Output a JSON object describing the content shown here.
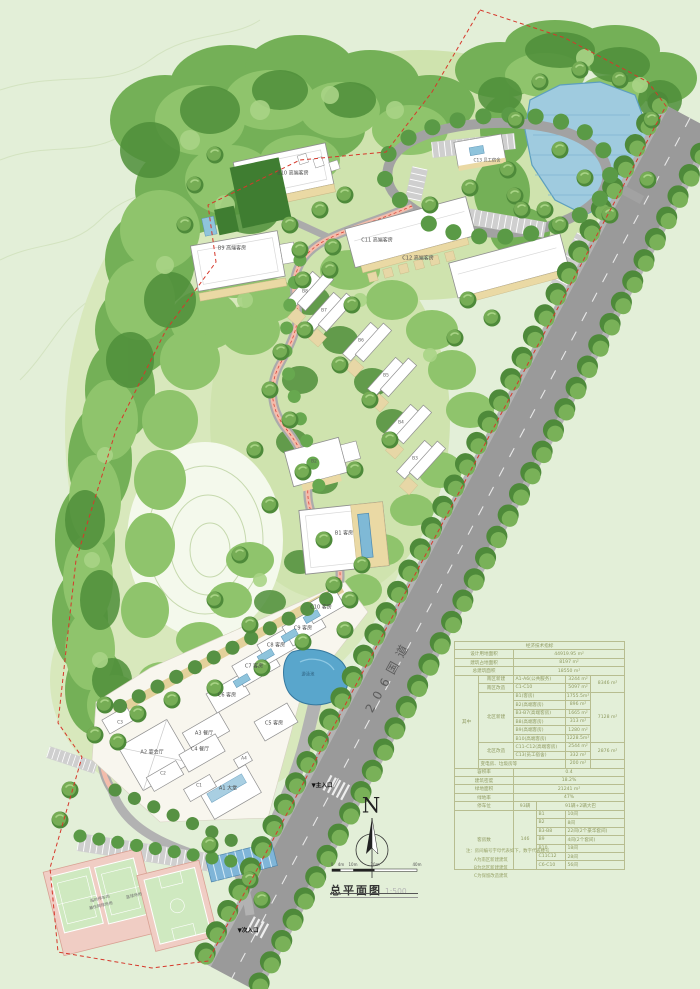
{
  "title_block": {
    "title": "总平面图",
    "scale": "1:500",
    "north_label": "N",
    "scale_bar_ticks": [
      "0",
      "4m",
      "10m",
      "20m",
      "40m"
    ]
  },
  "labels": {
    "road": "206国道",
    "main_entrance": "▼主入口",
    "side_entrance": "▼次入口",
    "pool": "游泳池",
    "tennis1": "临时停车场",
    "tennis2": "兼作网球场地",
    "basketball": "篮球场地",
    "a1": "A1 大堂",
    "a2": "A2 宴会厅",
    "a3": "A3 餐厅",
    "a4": "A4",
    "b1": "B1 客房",
    "b2": "B2",
    "b3": "B3",
    "b4": "B4",
    "b5": "B5",
    "b6": "B6",
    "b7": "B7",
    "b8": "B8",
    "b9": "B9 高端客房",
    "b10": "B10 高端客房",
    "c1": "C1",
    "c2": "C2",
    "c3": "C3",
    "c4": "C4 餐厅",
    "c5": "C5 客房",
    "c6": "C6 客房",
    "c7": "C7 客房",
    "c8": "C8 客房",
    "c9": "C9 客房",
    "c10": "C10 客房",
    "c11": "C11 高端客房",
    "c12": "C12 高端客房",
    "c13": "C13 员工宿舍"
  },
  "table": {
    "header": "经济技术指标",
    "r_land": {
      "label": "设计用地面积",
      "value": "44919.95 m²"
    },
    "r_footprint": {
      "label": "建筑占地面积",
      "value": "8197  m²"
    },
    "r_total": {
      "label": "总建筑面积",
      "value": "18550  m²"
    },
    "among_label": "其中",
    "south_new": {
      "label": "南区新建",
      "name": "A1-A6(公共服务)",
      "value": "3244 m²"
    },
    "south_reno": {
      "label": "南区改造",
      "name": "C1-C10",
      "value": "5097 m²"
    },
    "south_subtotal": "8346 m²",
    "north_new": {
      "label": "北区新建",
      "rows": [
        {
          "name": "B1(客房)",
          "value": "1755.5m²"
        },
        {
          "name": "B2(高端客房)",
          "value": "896  m²"
        },
        {
          "name": "B3-B7(高端客房)",
          "value": "1665  m²"
        },
        {
          "name": "B8(高端客房)",
          "value": "313  m²"
        },
        {
          "name": "B9(高端客房)",
          "value": "1280  m²"
        },
        {
          "name": "B10(高端客房)",
          "value": "1228.5m²"
        }
      ],
      "subtotal": "7128 m²"
    },
    "north_reno": {
      "label": "北区改造",
      "rows": [
        {
          "name": "C11-C12(高端客房)",
          "value": "2544 m²"
        },
        {
          "name": "C13(员工宿舍)",
          "value": "332  m²"
        }
      ],
      "subtotal": "2876 m²"
    },
    "utility": {
      "label": "变电房、垃圾房等",
      "value": "200  m²"
    },
    "far": {
      "label": "容积率",
      "value": "0.4"
    },
    "density": {
      "label": "建筑密度",
      "value": "18.2%"
    },
    "green_area": {
      "label": "绿地面积",
      "value": "21241  m²"
    },
    "green_ratio": {
      "label": "绿地率",
      "value": "47%"
    },
    "parking": {
      "label": "停车位",
      "value": "93辆",
      "detail": "91辆+2辆大巴"
    },
    "rooms": {
      "label": "客房数",
      "total": "146",
      "rows": [
        {
          "name": "B1",
          "value": "10间"
        },
        {
          "name": "B2",
          "value": "8间"
        },
        {
          "name": "B3-B8",
          "value": "22间(2个豪华套间)"
        },
        {
          "name": "B9",
          "value": "4间(2个套间)"
        },
        {
          "name": "B10",
          "value": "18间"
        },
        {
          "name": "C11C12",
          "value": "28间"
        },
        {
          "name": "C6-C10",
          "value": "56间"
        }
      ]
    }
  },
  "notes": {
    "title": "注：房间编号字母代表如下，数字代表楼号",
    "a": "A为南区新建建筑",
    "b": "B为北区新建建筑",
    "c": "C为保留改造建筑"
  },
  "colors": {
    "boundary_red": "#d6382b",
    "lake_blue": "#9fcbdf",
    "road_gray": "#9a9a9a",
    "path_pink": "#f3bcab",
    "canopy_green": "#6fae52",
    "court_green": "#cfe9c0",
    "deck_tan": "#ead9a4"
  }
}
